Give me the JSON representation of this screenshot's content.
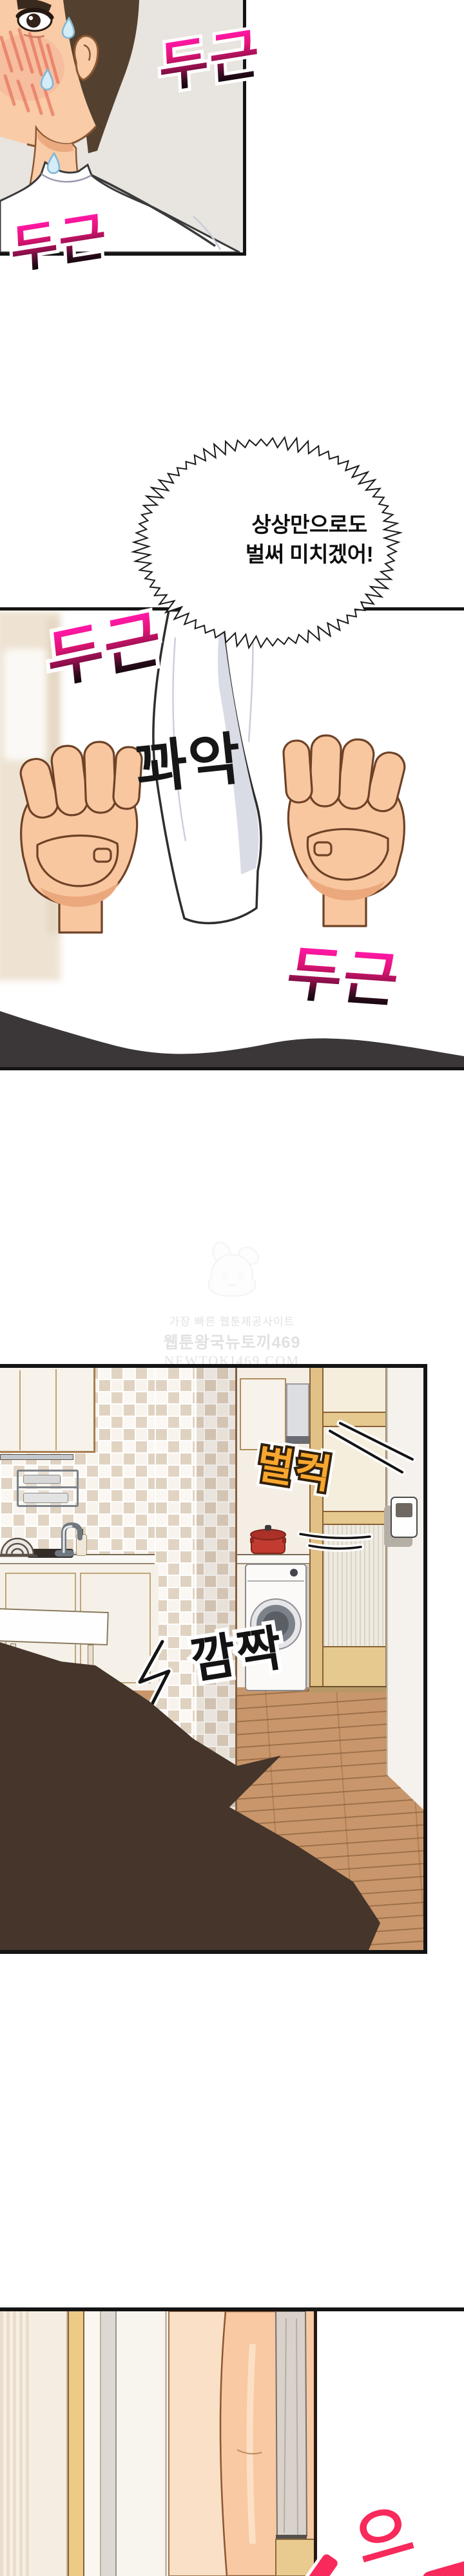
{
  "speech_bubble": {
    "line1": "상상만으로도",
    "line2": "벌써 미치겠어!"
  },
  "sfx": {
    "heartbeat_1": "두근",
    "heartbeat_2": "두근",
    "heartbeat_3": "두근",
    "heartbeat_4": "두근",
    "grip": "꽈악",
    "door_open": "벌컥",
    "startled": "깜짝",
    "gasp_partial": "으"
  },
  "watermark": {
    "tagline": "가장 빠른 웹툰제공사이트",
    "site_name": "웹툰왕국뉴토끼469",
    "site_url": "NEWTOKI469.COM"
  },
  "colors": {
    "sfx_pink_top": "#FF17A5",
    "sfx_gradient_bottom": "#0B0508",
    "sfx_orange": "#F7A62E",
    "sfx_red": "#F8295B",
    "panel_border": "#141414",
    "skin": "#F8C7A0",
    "floor_wood": "#C8966A"
  }
}
